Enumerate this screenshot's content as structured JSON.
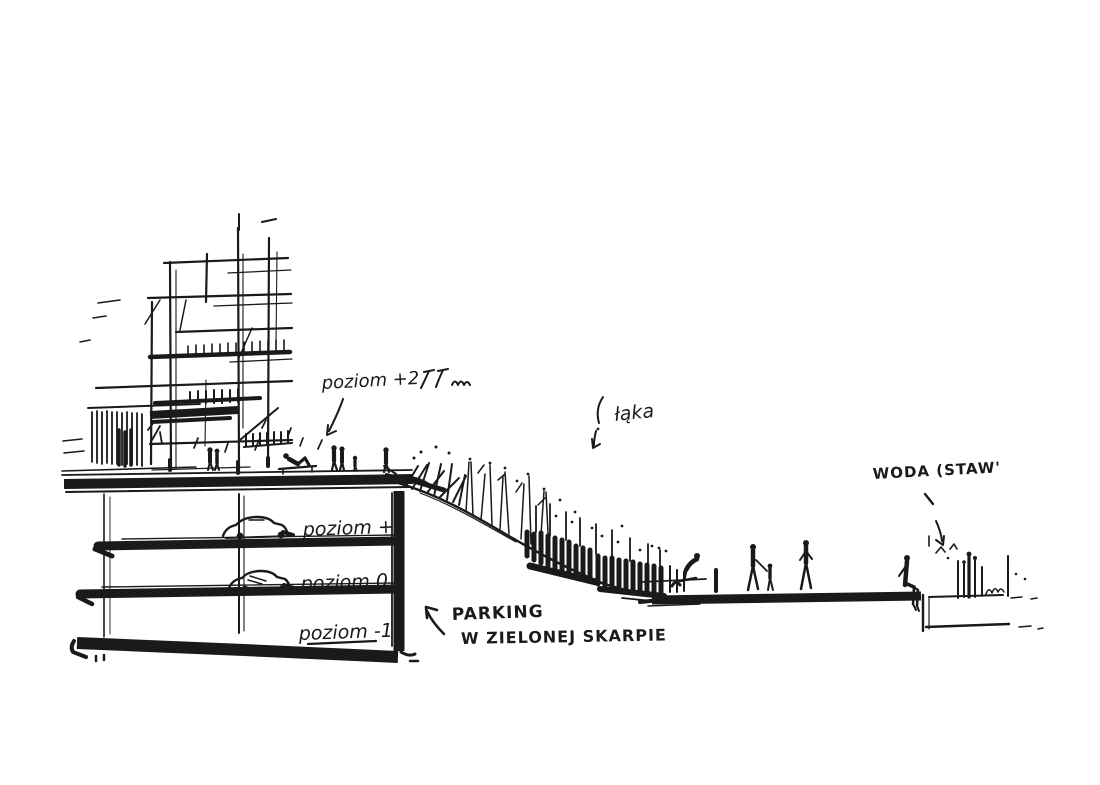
{
  "colors": {
    "ink": "#1a1a1a",
    "paper": "#ffffff"
  },
  "annotations": {
    "poziom_plus2": "poziom +2",
    "laka": "łąka",
    "woda_staw": "WODA (STAW'",
    "poziom_plus1": "poziom +1",
    "poziom_zero": "poziom 0",
    "poziom_minus1": "poziom -1",
    "parking_line1": "PARKING",
    "parking_line2": "W ZIELONEJ SKARPIE"
  }
}
